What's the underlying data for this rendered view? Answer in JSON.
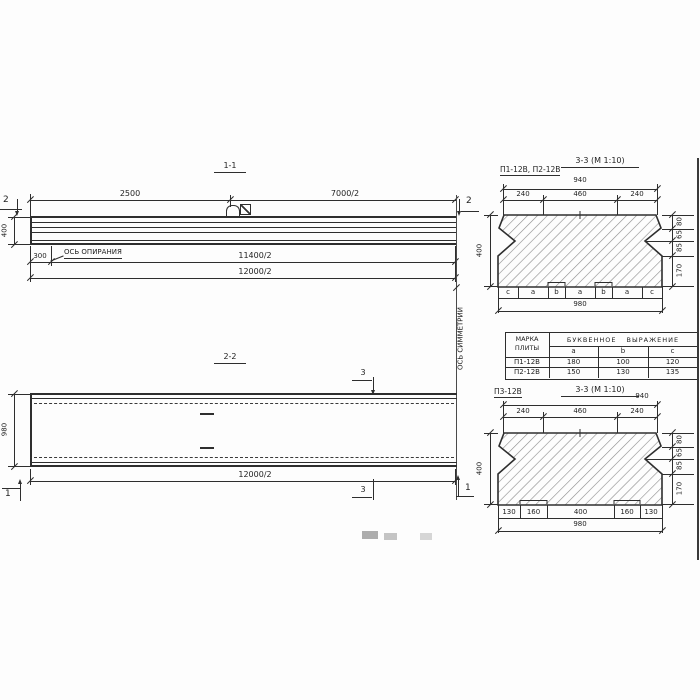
{
  "s11": {
    "title": "1-1",
    "marker": "2",
    "dim_top_left": "2500",
    "dim_top_right": "7000/2",
    "dim_height": "400",
    "dim_support": "300",
    "support_axis": "ОСЬ ОПИРАНИЯ",
    "dim_len1": "11400/2",
    "dim_len2": "12000/2"
  },
  "axis": {
    "symmetry": "ОСЬ СИММЕТРИИ"
  },
  "s22": {
    "title": "2-2",
    "marker_section": "3",
    "marker_end": "1",
    "dim_height": "980",
    "dim_len": "12000/2"
  },
  "s33a": {
    "label": "П1-12В, П2-12В",
    "title": "3-3 (М 1:10)",
    "dim_940": "940",
    "parts": [
      "240",
      "460",
      "240"
    ],
    "dim_400": "400",
    "chain": [
      "80",
      "65",
      "85",
      "170"
    ],
    "letters": [
      "c",
      "a",
      "b",
      "a",
      "b",
      "a",
      "c"
    ],
    "dim_980": "980"
  },
  "table": {
    "h_mark1": "МАРКА",
    "h_mark2": "ПЛИТЫ",
    "h_expr": "БУКВЕННОЕ ВЫРАЖЕНИЕ",
    "cols": [
      "a",
      "b",
      "c"
    ],
    "rows": [
      [
        "П1-12В",
        "180",
        "100",
        "120"
      ],
      [
        "П2-12В",
        "150",
        "130",
        "135"
      ]
    ]
  },
  "s33b": {
    "label": "П3-12В",
    "title": "3-3 (М 1:10)",
    "dim_940": "940",
    "parts": [
      "240",
      "460",
      "240"
    ],
    "dim_400": "400",
    "chain": [
      "80",
      "65",
      "85",
      "170"
    ],
    "bottom": [
      "130",
      "160",
      "400",
      "160",
      "130"
    ],
    "dim_980": "980"
  }
}
